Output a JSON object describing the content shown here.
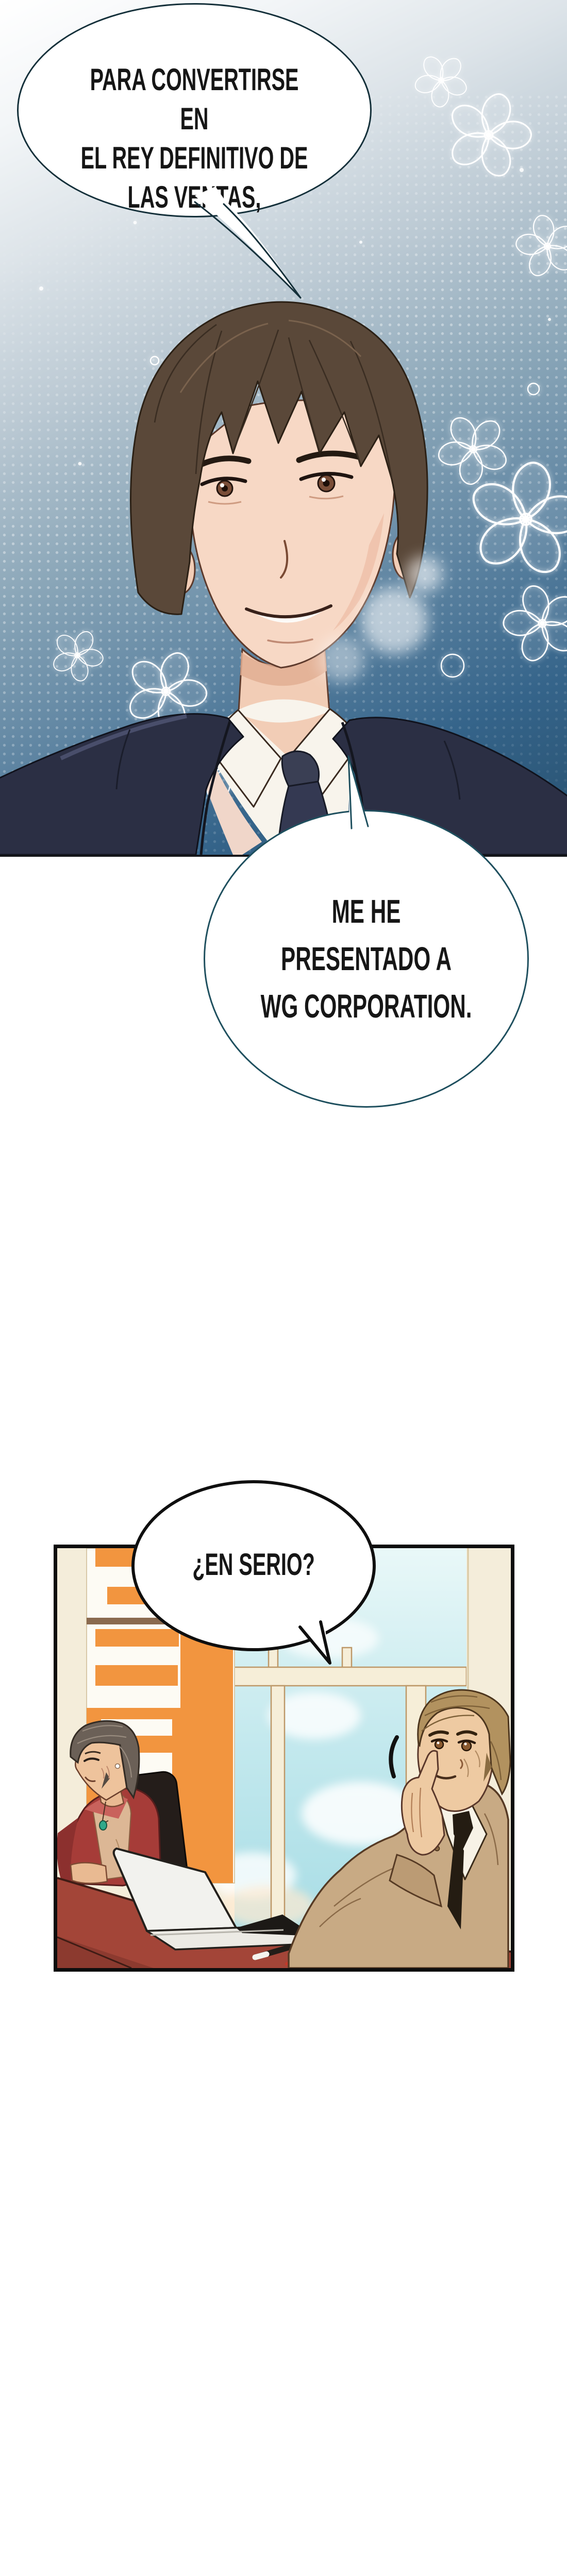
{
  "comic": {
    "page_type": "webtoon-strip",
    "bubbles": [
      {
        "id": "bubble-1",
        "speaker": "protagonist",
        "text": "PARA CONVERTIRSE EN\nEL REY DEFINITIVO DE\nLAS VENTAS,"
      },
      {
        "id": "bubble-2",
        "speaker": "protagonist",
        "text": "ME HE PRESENTADO A\nWG CORPORATION."
      },
      {
        "id": "bubble-3",
        "speaker": "interviewer",
        "text": "¿EN SERIO?"
      }
    ],
    "colors": {
      "bubble_outline_teal": "#1e4f5e",
      "bubble_outline_black": "#0f0f0f",
      "portrait_bg_deep_blue": "#27506e",
      "suit_navy": "#2b2f44",
      "office_wall_cream": "#f4edda",
      "poster_orange": "#f2953f",
      "sky_cyan": "#bfe7ec",
      "desk_maroon": "#a34538",
      "blazer_red": "#a63c38",
      "suit_tan": "#c8aa84",
      "pendant_green": "#2fa98a"
    }
  }
}
